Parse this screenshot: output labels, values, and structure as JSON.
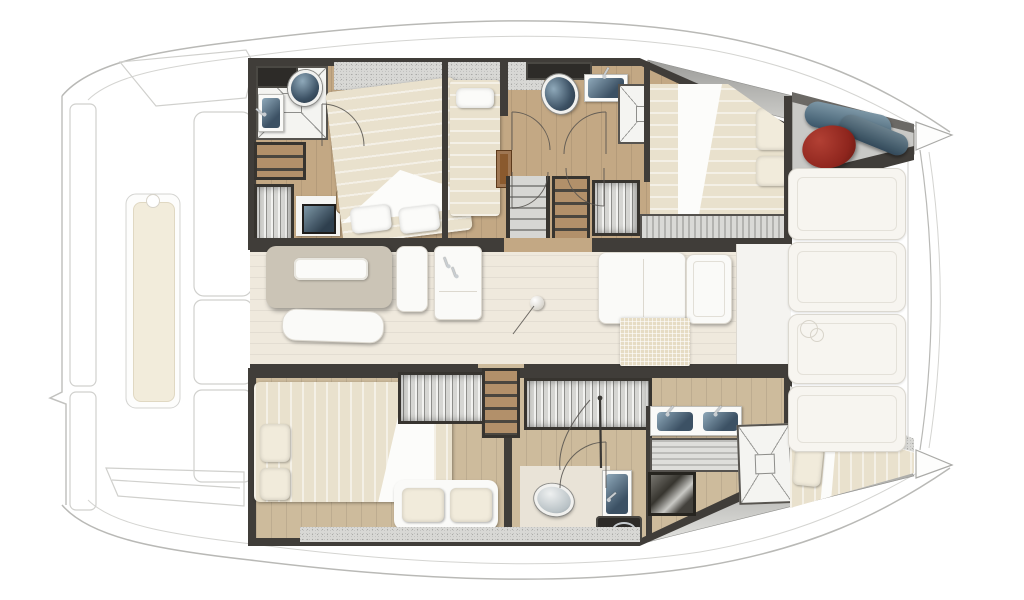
{
  "diagram": {
    "type": "floorplan",
    "subject": "catamaran yacht interior layout, top-down view, bows to the right",
    "areas": [
      "aft cockpit with lounge bench (ghost outline, left)",
      "port hull (top): aft bathroom with shower, toilet and washbasin; aft double cabin; single berth; forward bathroom with shower; forward double cabin; bow locker with fenders",
      "saloon (center): dining table with tray, bench seating, galley island with sink, galley counters, woven mat",
      "starboard hull (bottom): aft owner cabin with double bed, wardrobes and sofa; twin washbasin vanity; toilet compartment; shower; forward v-berth",
      "foredeck (right): sunpad panels, trampoline beam, twin bow tips"
    ],
    "fixtures": [
      "toilet-icon",
      "washbasin-icon",
      "shower-xfloor-icon",
      "bed-icon",
      "pillow-icon",
      "wardrobe-icon",
      "stairs-icon",
      "table-icon",
      "sofa-icon",
      "sink-faucet-icon",
      "fender-icon",
      "door-swing-arc-icon"
    ]
  },
  "palette": {
    "wall": "#403d39",
    "wallDark": "#2d2b28",
    "woodTop": "#c3a884",
    "woodBottom": "#cdbb9c",
    "saloonFloor": "#efe9dd",
    "tile": "#f4f4f1",
    "fixtureWhite": "#fafaf8",
    "basinDeep": "#3c5164",
    "basinLight": "#8fa9ba",
    "chrome": "#c9ced2",
    "bedBase": "#e9e1cd",
    "pillow": "#f1ebdb",
    "cushion": "#f2ecdb",
    "speckle": "#d8d8d5",
    "woodStep": "#b2906a",
    "doorWood": "#8a5a2e",
    "fenderRed": "#942620",
    "fenderBlue": "#5d7a8c",
    "mat": "#e6dcc4",
    "table": "#cbc4b6",
    "ghostLine": "#cfcfcc"
  }
}
